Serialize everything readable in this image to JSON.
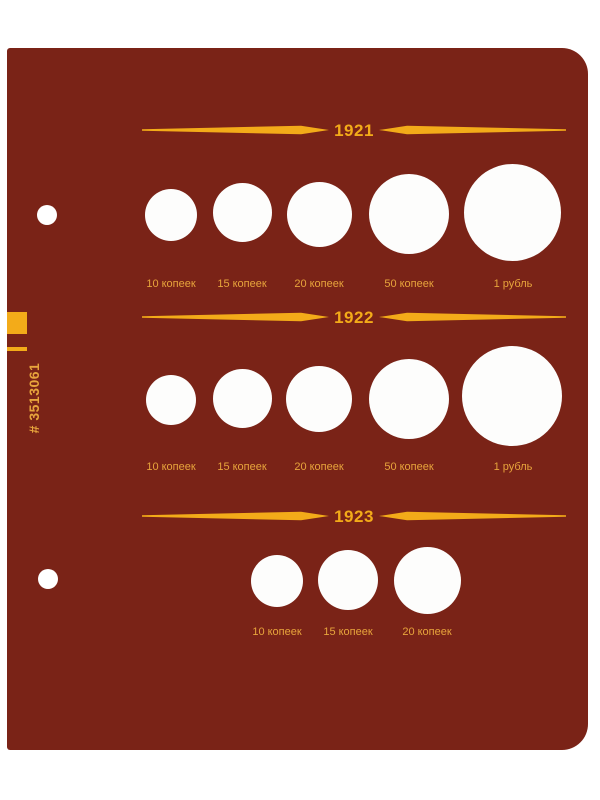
{
  "page": {
    "catalog_number": "# 3513061"
  },
  "colors": {
    "page_bg": "#7a2317",
    "surround": "#ffffff",
    "gold": "#f3ab19",
    "label_gold": "#e7a43c",
    "hole_white": "#fdfdfc"
  },
  "sections": [
    {
      "year": "1921",
      "coins": [
        {
          "label": "10 копеек"
        },
        {
          "label": "15 копеек"
        },
        {
          "label": "20 копеек"
        },
        {
          "label": "50 копеек"
        },
        {
          "label": "1 рубль"
        }
      ]
    },
    {
      "year": "1922",
      "coins": [
        {
          "label": "10 копеек"
        },
        {
          "label": "15 копеек"
        },
        {
          "label": "20 копеек"
        },
        {
          "label": "50 копеек"
        },
        {
          "label": "1 рубль"
        }
      ]
    },
    {
      "year": "1923",
      "coins": [
        {
          "label": "10 копеек"
        },
        {
          "label": "15 копеек"
        },
        {
          "label": "20 копеек"
        }
      ]
    }
  ]
}
